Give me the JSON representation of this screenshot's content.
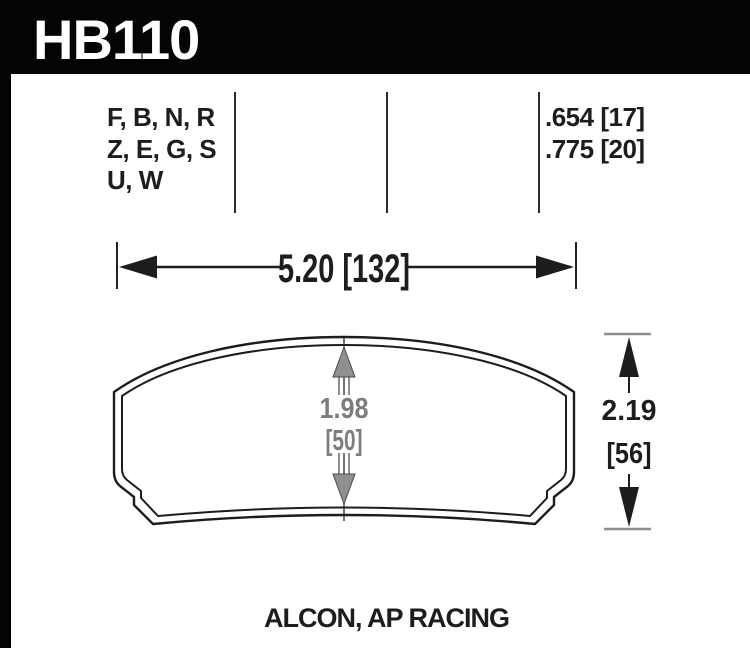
{
  "page": {
    "background": "#ffffff"
  },
  "header": {
    "part_number": "HB110",
    "band_color": "#040404",
    "text_color": "#ffffff"
  },
  "spec": {
    "compound_lines": [
      "F, B, N, R",
      "Z, E, G, S",
      "U, W"
    ],
    "thickness_lines": [
      ".654 [17]",
      ".775 [20]"
    ]
  },
  "dimensions": {
    "overall_width": "5.20 [132]",
    "friction_height": {
      "in": "1.98",
      "mm": "[50]"
    },
    "overall_height": {
      "in": "2.19",
      "mm": "[56]"
    }
  },
  "footer": {
    "caliper_applications": "ALCON, AP RACING"
  },
  "colors": {
    "ink": "#1d1d1d",
    "dim_gray": "#7d7d7d",
    "arrow_gray": "#8e8e8e"
  }
}
